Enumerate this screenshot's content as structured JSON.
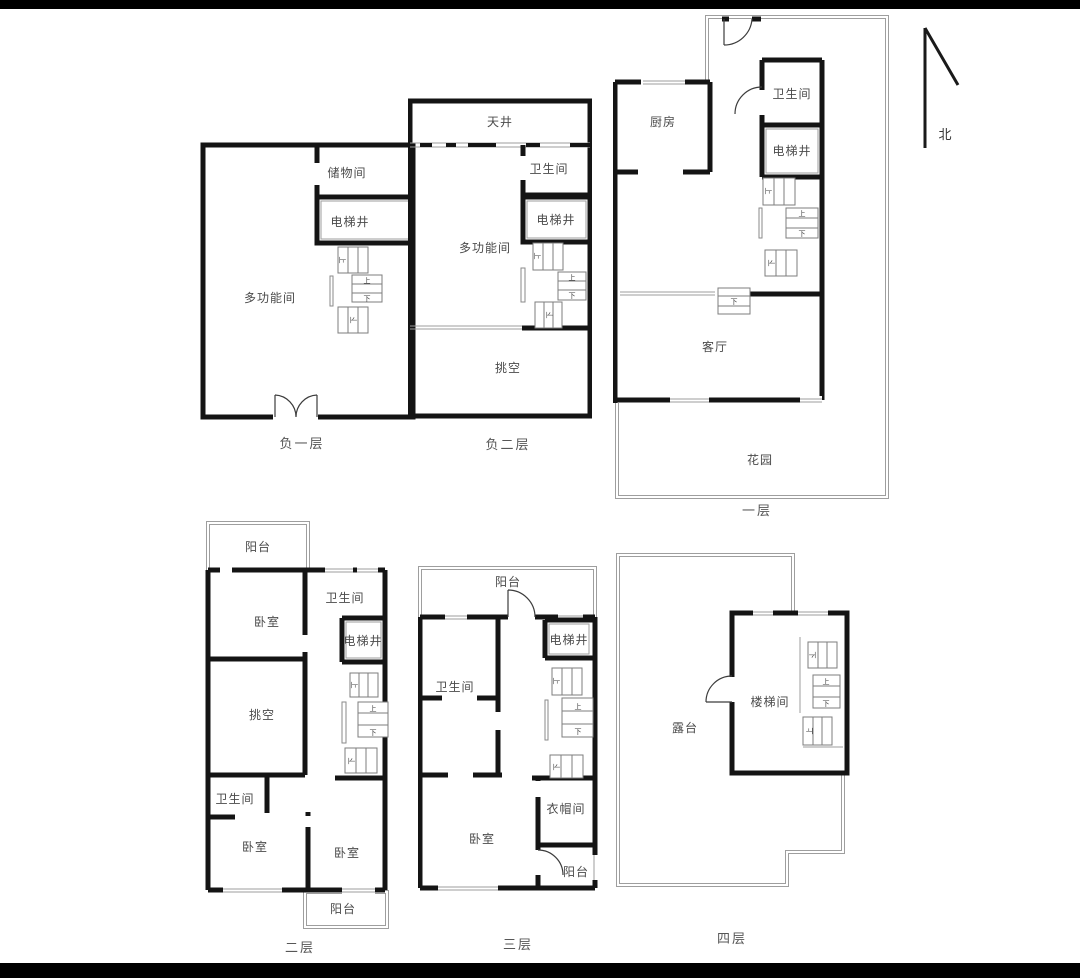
{
  "compass": {
    "label": "北"
  },
  "stairs": {
    "up": "上",
    "down": "下"
  },
  "colors": {
    "wall": "#141414",
    "thin_line": "#9e9e9e",
    "room_text": "#4a4a4a",
    "caption_text": "#575757",
    "background": "#ffffff",
    "letterbox": "#000000"
  },
  "plans": {
    "b1": {
      "caption": "负一层",
      "rooms": {
        "multi": "多功能间",
        "storage": "储物间",
        "elevator": "电梯井"
      }
    },
    "b2": {
      "caption": "负二层",
      "rooms": {
        "skylight": "天井",
        "bath": "卫生间",
        "elevator": "电梯井",
        "multi": "多功能间",
        "void": "挑空"
      }
    },
    "f1": {
      "caption": "一层",
      "rooms": {
        "kitchen": "厨房",
        "bath": "卫生间",
        "elevator": "电梯井",
        "living": "客厅",
        "garden": "花园"
      }
    },
    "f2": {
      "caption": "二层",
      "rooms": {
        "balcony_top": "阳台",
        "bedroom_a": "卧室",
        "bath_a": "卫生间",
        "elevator": "电梯井",
        "void": "挑空",
        "bath_b": "卫生间",
        "bedroom_b": "卧室",
        "bedroom_c": "卧室",
        "balcony_bottom": "阳台"
      }
    },
    "f3": {
      "caption": "三层",
      "rooms": {
        "balcony_top": "阳台",
        "bath": "卫生间",
        "elevator": "电梯井",
        "bedroom": "卧室",
        "cloakroom": "衣帽间",
        "balcony_bottom": "阳台"
      }
    },
    "f4": {
      "caption": "四层",
      "rooms": {
        "terrace": "露台",
        "stairwell": "楼梯间"
      }
    }
  }
}
